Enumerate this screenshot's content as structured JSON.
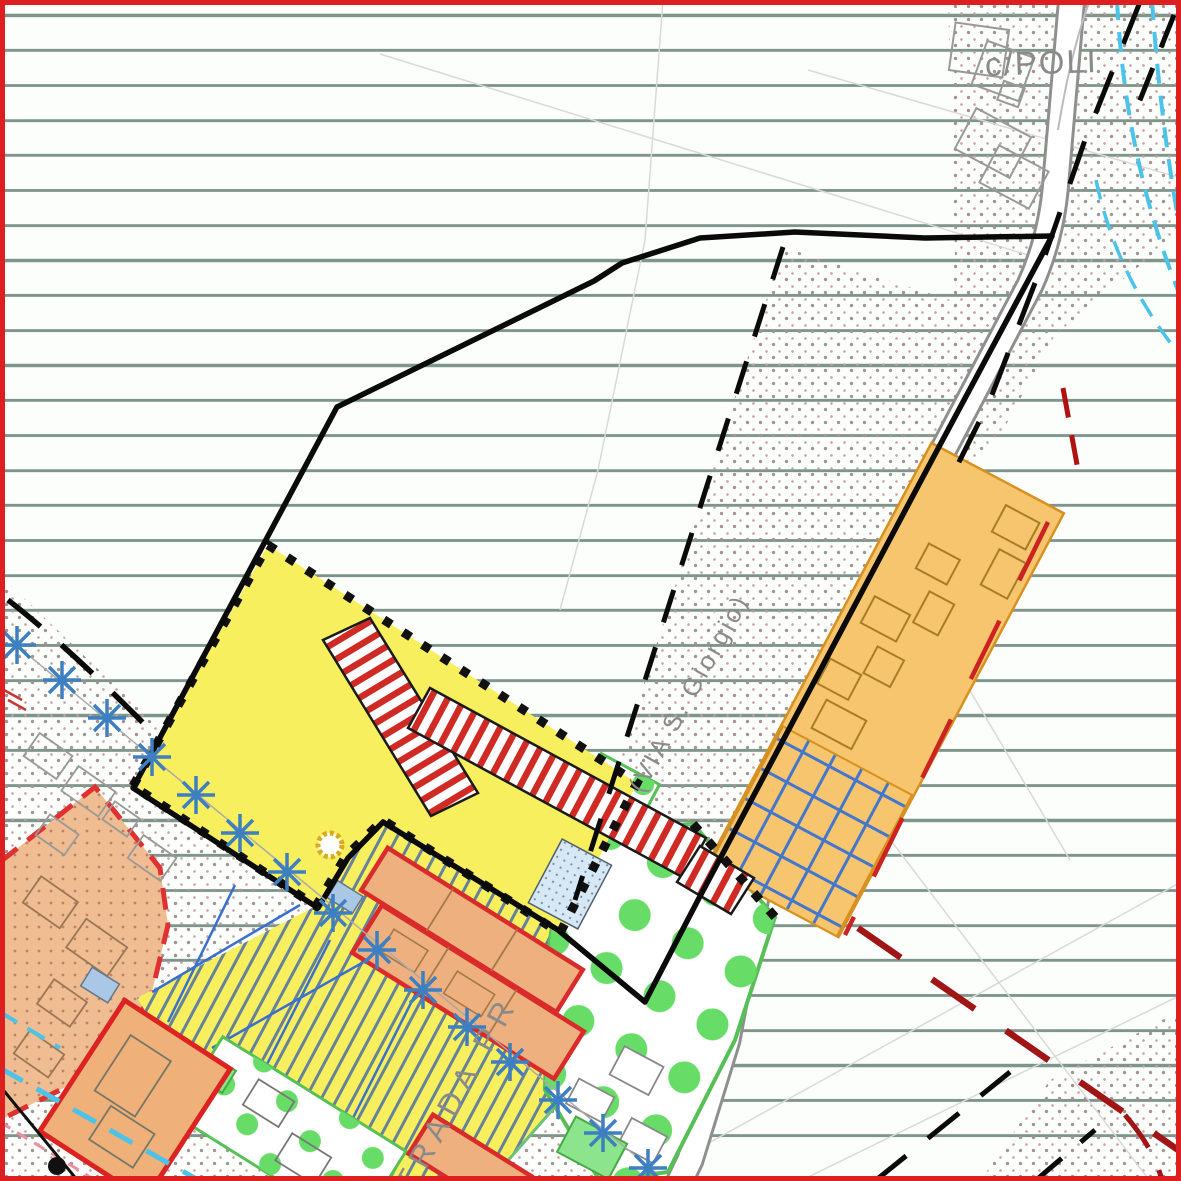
{
  "map": {
    "labels": {
      "area_top_right": "c/POLI",
      "street_bottom": "STRADA PR",
      "street_side": "(VIA S. Giorgio)"
    },
    "colors": {
      "frame_red": "#de1f1f",
      "contour_green_line": "#7e958b",
      "zone_yellow": "#f8ef5e",
      "zone_stripe_red": "#cf2b24",
      "zone_orange_band": "#f6c56d",
      "zone_orange_blocks": "#eeb07e",
      "zone_orange_dashed": "#f0bd92",
      "park_green_dot": "#67dd67",
      "park_green_border": "#56c056",
      "hatch_blue": "#4a6fa5",
      "parcel_blue": "#3a6fd0",
      "tree_symbol_blue": "#3d7fc1",
      "utility_cyan": "#4cc3e8",
      "constraint_dark_red": "#a01515",
      "boundary_black": "#111111",
      "road_casing_gray": "#8f8f8f",
      "text_gray": "#8a8a8a"
    },
    "tree_symbols": [
      [
        17,
        645
      ],
      [
        62,
        680
      ],
      [
        107,
        718
      ],
      [
        152,
        757
      ],
      [
        196,
        795
      ],
      [
        240,
        833
      ],
      [
        287,
        872
      ],
      [
        333,
        913
      ],
      [
        377,
        950
      ],
      [
        423,
        990
      ],
      [
        467,
        1027
      ],
      [
        510,
        1062
      ],
      [
        558,
        1100
      ],
      [
        603,
        1133
      ],
      [
        648,
        1168
      ]
    ]
  }
}
